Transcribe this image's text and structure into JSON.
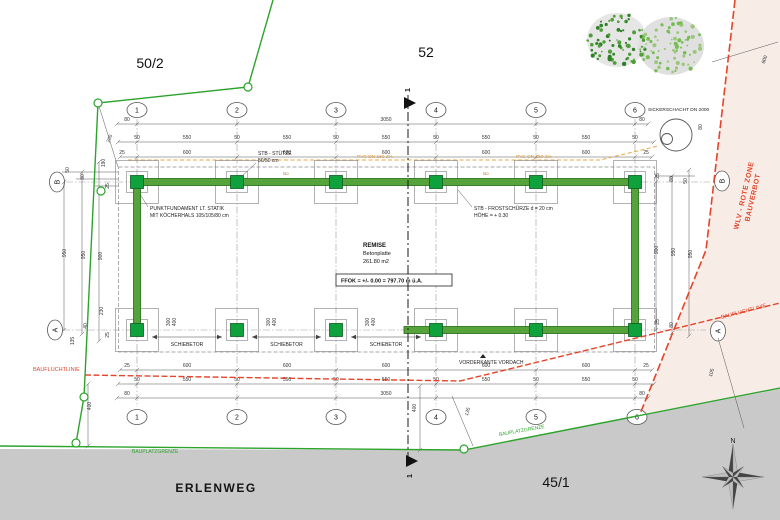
{
  "parcels": {
    "left": "50/2",
    "top": "52",
    "bottom": "45/1"
  },
  "street": "ERLENWEG",
  "zone": {
    "line1": "WLV - ROTE ZONE",
    "line2": "BAUVERBOT"
  },
  "boundary": {
    "site": "BAUPLATZGRENZE",
    "build_line": "BAUFLUCHTLINIE"
  },
  "building": {
    "name": "REMISE",
    "slab": "Betonplatte",
    "area": "261.80 m2",
    "ffok": "FFOK = +/- 0.00 = 797.70 m ü.A."
  },
  "notes": {
    "stuetze1": "STB - STÜTZE",
    "stuetze2": "50/50 cm",
    "fund1": "PUNKTFUNDAMENT LT. STATIK",
    "fund2": "MIT KÖCHERHALS 105/105/80 cm",
    "frost1": "STB - FROSTSCHÜRZE d = 20 cm",
    "frost2": "HÖHE = + 0.30",
    "vordach": "VORDERKANTE VORDACH",
    "gate": "SCHIEBETOR",
    "shaft": "SICKERSCHACHT DN 2000",
    "pvc": "PVC DN 150  2% →",
    "iso": "Iso"
  },
  "grid": {
    "cols": [
      "1",
      "2",
      "3",
      "4",
      "5",
      "6"
    ],
    "row_top": "B",
    "row_bottom": "A"
  },
  "section": {
    "number": "1"
  },
  "compass": {
    "north": "N"
  },
  "colors": {
    "green": "#2ca32c",
    "beam": "#57a33b",
    "beam_edge": "#1d6b15",
    "footing": "#0fa23c",
    "orange": "#eba53d",
    "red": "#e4442a",
    "road": "#c9c9c9",
    "zone_fill": "#f8ece6"
  },
  "gate_dims": [
    {
      "a": "300",
      "b": "400"
    },
    {
      "a": "300",
      "b": "400"
    },
    {
      "a": "300",
      "b": "400"
    }
  ],
  "dim_texts": [
    {
      "t": "80",
      "x": 127,
      "y": 121
    },
    {
      "t": "3050",
      "x": 386,
      "y": 121
    },
    {
      "t": "80",
      "x": 642,
      "y": 121
    },
    {
      "t": "50",
      "x": 137,
      "y": 139
    },
    {
      "t": "550",
      "x": 187,
      "y": 139
    },
    {
      "t": "50",
      "x": 237,
      "y": 139
    },
    {
      "t": "550",
      "x": 287,
      "y": 139
    },
    {
      "t": "50",
      "x": 336,
      "y": 139
    },
    {
      "t": "550",
      "x": 386,
      "y": 139
    },
    {
      "t": "50",
      "x": 436,
      "y": 139
    },
    {
      "t": "550",
      "x": 486,
      "y": 139
    },
    {
      "t": "50",
      "x": 536,
      "y": 139
    },
    {
      "t": "550",
      "x": 586,
      "y": 139
    },
    {
      "t": "50",
      "x": 635,
      "y": 139
    },
    {
      "t": "25",
      "x": 122,
      "y": 154
    },
    {
      "t": "600",
      "x": 187,
      "y": 154
    },
    {
      "t": "600",
      "x": 287,
      "y": 154
    },
    {
      "t": "600",
      "x": 386,
      "y": 154
    },
    {
      "t": "600",
      "x": 486,
      "y": 154
    },
    {
      "t": "600",
      "x": 586,
      "y": 154
    },
    {
      "t": "25",
      "x": 646,
      "y": 154
    },
    {
      "t": "25",
      "x": 127,
      "y": 367
    },
    {
      "t": "600",
      "x": 187,
      "y": 367
    },
    {
      "t": "600",
      "x": 287,
      "y": 367
    },
    {
      "t": "600",
      "x": 386,
      "y": 367
    },
    {
      "t": "600",
      "x": 486,
      "y": 367
    },
    {
      "t": "600",
      "x": 586,
      "y": 367
    },
    {
      "t": "25",
      "x": 646,
      "y": 367
    },
    {
      "t": "50",
      "x": 137,
      "y": 381
    },
    {
      "t": "550",
      "x": 187,
      "y": 381
    },
    {
      "t": "50",
      "x": 237,
      "y": 381
    },
    {
      "t": "550",
      "x": 287,
      "y": 381
    },
    {
      "t": "50",
      "x": 336,
      "y": 381
    },
    {
      "t": "550",
      "x": 386,
      "y": 381
    },
    {
      "t": "50",
      "x": 436,
      "y": 381
    },
    {
      "t": "550",
      "x": 486,
      "y": 381
    },
    {
      "t": "50",
      "x": 536,
      "y": 381
    },
    {
      "t": "550",
      "x": 586,
      "y": 381
    },
    {
      "t": "50",
      "x": 635,
      "y": 381
    },
    {
      "t": "80",
      "x": 127,
      "y": 395
    },
    {
      "t": "3050",
      "x": 386,
      "y": 395
    },
    {
      "t": "80",
      "x": 642,
      "y": 395
    },
    {
      "t": "50",
      "x": 69,
      "y": 170,
      "r": -90
    },
    {
      "t": "80",
      "x": 84,
      "y": 177,
      "r": -90
    },
    {
      "t": "25",
      "x": 109,
      "y": 186,
      "r": -90
    },
    {
      "t": "190",
      "x": 105,
      "y": 163,
      "r": -90
    },
    {
      "t": "950",
      "x": 66,
      "y": 253,
      "r": -90
    },
    {
      "t": "950",
      "x": 85,
      "y": 255,
      "r": -90
    },
    {
      "t": "900",
      "x": 102,
      "y": 256,
      "r": -90
    },
    {
      "t": "230",
      "x": 103,
      "y": 311,
      "r": -90
    },
    {
      "t": "40",
      "x": 87,
      "y": 326,
      "r": -90
    },
    {
      "t": "25",
      "x": 109,
      "y": 335,
      "r": -90
    },
    {
      "t": "135",
      "x": 74,
      "y": 341,
      "r": -90
    },
    {
      "t": "400",
      "x": 91,
      "y": 406,
      "r": -90
    },
    {
      "t": "205",
      "x": 111,
      "y": 139,
      "r": -68
    },
    {
      "t": "900",
      "x": 658,
      "y": 250,
      "r": -90
    },
    {
      "t": "950",
      "x": 675,
      "y": 252,
      "r": -90
    },
    {
      "t": "950",
      "x": 692,
      "y": 254,
      "r": -90
    },
    {
      "t": "25",
      "x": 659,
      "y": 176,
      "r": -90
    },
    {
      "t": "80",
      "x": 673,
      "y": 179,
      "r": -90
    },
    {
      "t": "50",
      "x": 687,
      "y": 181,
      "r": -90
    },
    {
      "t": "25",
      "x": 659,
      "y": 322,
      "r": -90
    },
    {
      "t": "80",
      "x": 673,
      "y": 325,
      "r": -90
    },
    {
      "t": "80",
      "x": 702,
      "y": 127,
      "r": -90
    },
    {
      "t": "800",
      "x": 766,
      "y": 60,
      "r": -70
    },
    {
      "t": "135",
      "x": 469,
      "y": 412,
      "r": -72
    },
    {
      "t": "105",
      "x": 713,
      "y": 373,
      "r": -75
    },
    {
      "t": "400",
      "x": 416,
      "y": 408,
      "r": -90
    }
  ]
}
